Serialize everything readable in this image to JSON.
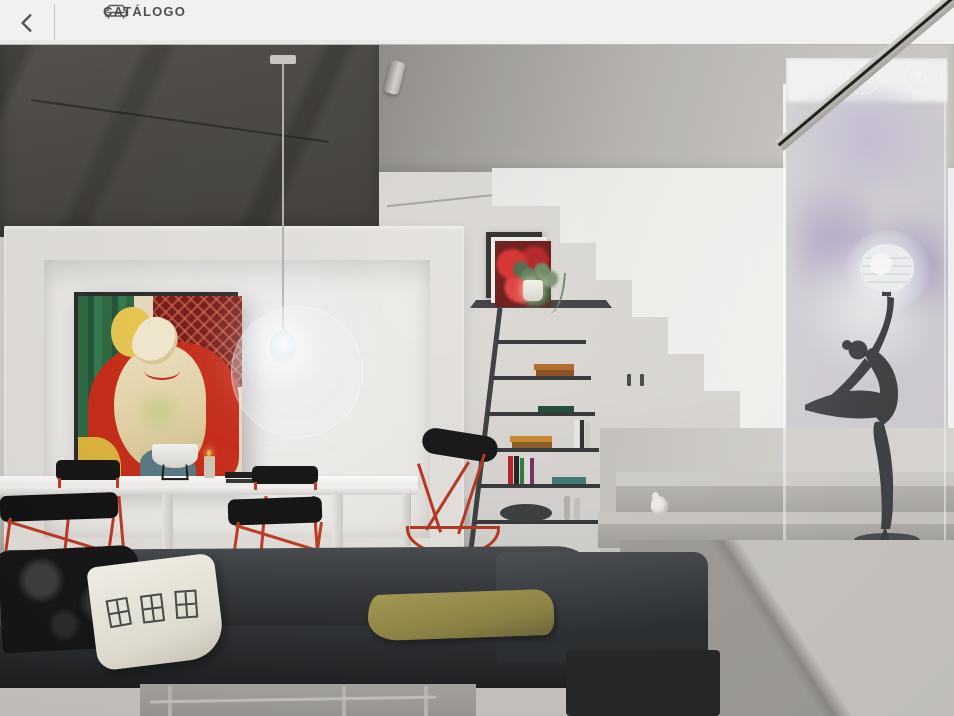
{
  "toolbar": {
    "catalog_label": "CATÁLOGO",
    "items": [
      {
        "label": "Editar imagem",
        "icon": "image-icon"
      },
      {
        "label": "Estilo",
        "icon": "paint-roller-icon"
      },
      {
        "label": "Grade",
        "icon": "grid-icon"
      },
      {
        "label": "Ajuda",
        "icon": "help-icon"
      },
      {
        "label": "Excluir itens",
        "icon": "trash-icon"
      },
      {
        "label": "Captura de tela",
        "icon": "camera-icon"
      },
      {
        "label": "Quarto vazio",
        "icon": "empty-room-icon"
      },
      {
        "label": "Salvar projeto",
        "icon": "save-icon"
      },
      {
        "label": "Compartilhe",
        "icon": "share-icon"
      }
    ]
  },
  "canvas_controls": {
    "undo_glyph": "↺",
    "redo_glyph": "↻"
  },
  "colors": {
    "toolbar_bg": "#f3f2f0",
    "icon_gray": "#5a5a5a",
    "accent_red": "#bf3b24",
    "sofa_charcoal": "#2c2f32",
    "olive_cushion": "#9a9150",
    "wall_light": "#d8d5d1",
    "concrete_dark": "#4e4b45",
    "painting_red": "#c92c18",
    "painting_green": "#2e6b44"
  }
}
